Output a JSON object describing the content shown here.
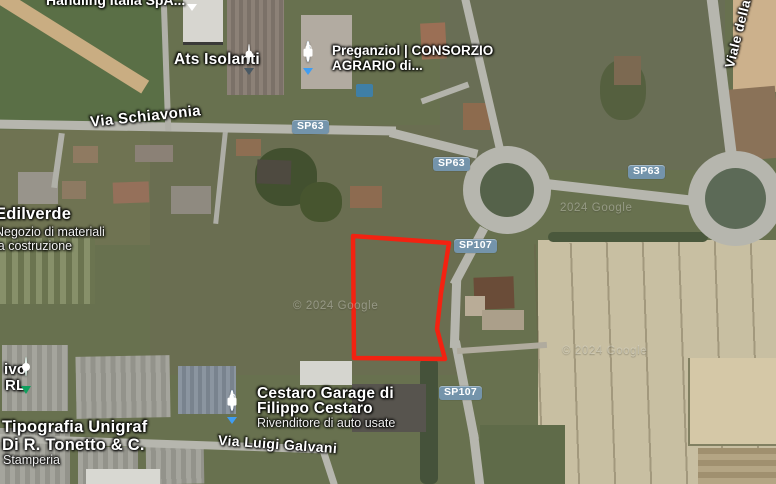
{
  "colors": {
    "parcel_outline": "#f32211",
    "badge_bg": "#7494ab",
    "pin_blue": "#3f9df2",
    "pin_green": "#0fa05e",
    "pin_generic": "#4a5964"
  },
  "pois": {
    "handling": {
      "name": "Handling Italia SpA..."
    },
    "ats": {
      "name": "Ats Isolanti"
    },
    "preganziol": {
      "line1": "Preganziol | CONSORZIO",
      "line2": "AGRARIO di..."
    },
    "edilverde": {
      "name": "Edilverde",
      "sub1": "Negozio di materiali",
      "sub2": "la costruzione"
    },
    "ivo": {
      "line1": "ivo",
      "line2": "RL"
    },
    "tipografia": {
      "line1": "Tipografia Unigraf",
      "line2": "Di R. Tonetto & C.",
      "sub": "Stamperia"
    },
    "cestaro": {
      "line1": "Cestaro Garage di",
      "line2": "Filippo Cestaro",
      "sub": "Rivenditore di auto usate"
    }
  },
  "roads": {
    "names": {
      "schiavonia": "Via Schiavonia",
      "galvani": "Via Luigi Galvani",
      "viale": "Viale della..."
    },
    "badges": [
      {
        "label": "SP63"
      },
      {
        "label": "SP63"
      },
      {
        "label": "SP63"
      },
      {
        "label": "SP107"
      },
      {
        "label": "SP107"
      }
    ]
  },
  "watermarks": [
    {
      "text": "2024 Google"
    },
    {
      "text": "© 2024 Google"
    },
    {
      "text": "© 2024 Google"
    }
  ]
}
